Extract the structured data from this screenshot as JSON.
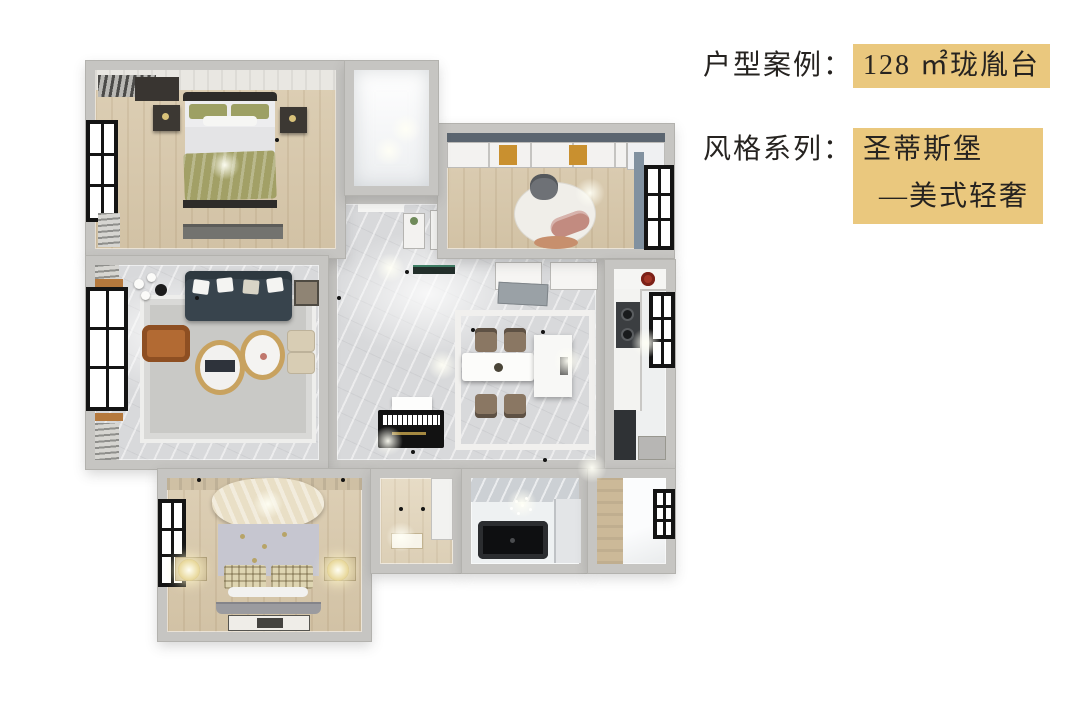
{
  "caption": {
    "line1": {
      "label": "户型案例：",
      "value": "128 ㎡珑胤台"
    },
    "line2": {
      "label": "风格系列：",
      "value": "圣蒂斯堡"
    },
    "line3": {
      "value": "—美式轻奢"
    }
  },
  "palette": {
    "highlight": "#eac87e",
    "text": "#262320",
    "wall": "#c6c5c2",
    "floor-wood": "#ddcfb5",
    "floor-marble": "#d8d9db",
    "rug": "#c9c9c6",
    "sofa": "#38444d",
    "armchair": "#b26a33",
    "blanket-green": "#a2a066",
    "blanket-cream": "#e9dfc6",
    "gold": "#c8a25f",
    "dark-furniture": "#33302c",
    "window-frame": "#141414",
    "chair-brown": "#8a7763",
    "tub": "#0e0f11"
  }
}
